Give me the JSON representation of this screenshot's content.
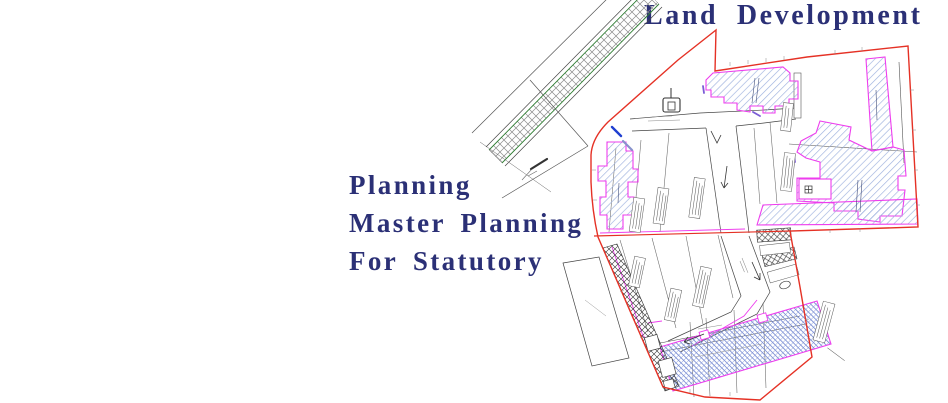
{
  "header": {
    "title": "Land Development"
  },
  "services": {
    "items": [
      "Planning",
      "Master Planning",
      "For Statutory"
    ]
  },
  "drawing": {
    "kind": "site-master-plan-drawing",
    "colors": {
      "accent_text": "#2b3076",
      "boundary_red": "#e53125",
      "building_magenta": "#ee3dee",
      "hatch_blue": "#96a8d8",
      "paving_green": "#2e7d32"
    }
  }
}
